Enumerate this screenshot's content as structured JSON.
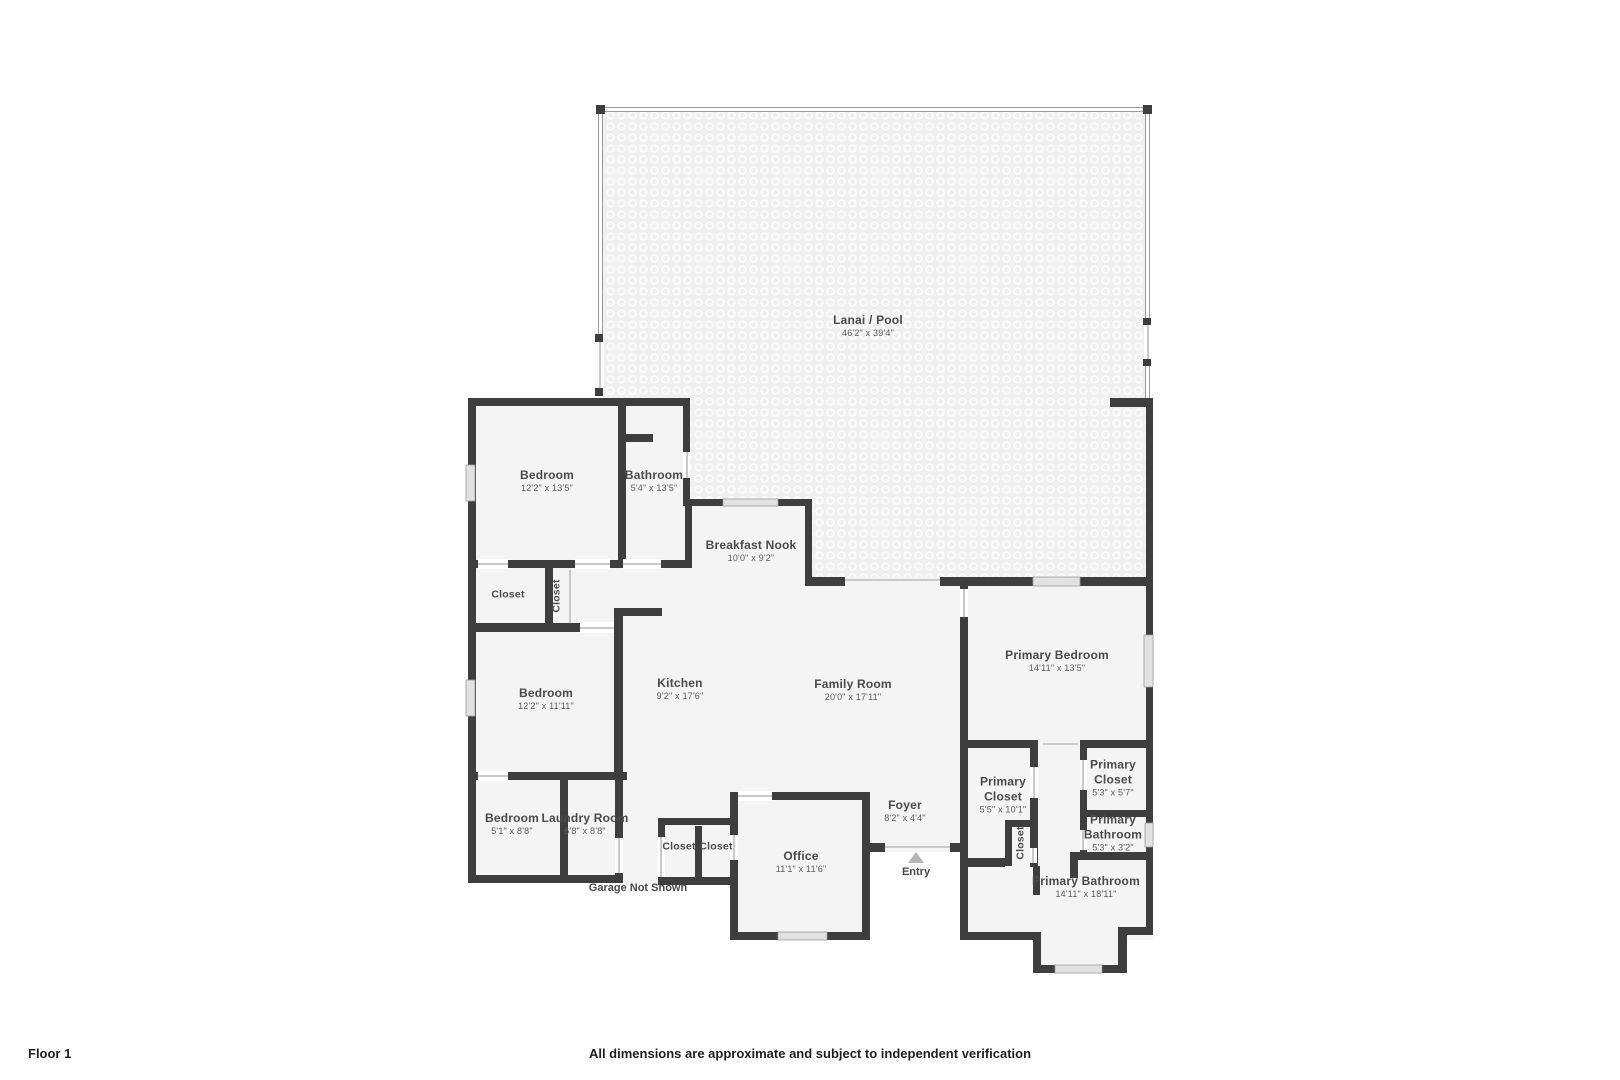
{
  "colors": {
    "wall": "#3e3e3e",
    "room_fill": "#f4f4f4",
    "lanai_fill": "#f0f0f0",
    "thin_wall": "#9b9b9b",
    "window": "#e2e2e2",
    "door": "#c9c9c9",
    "label_text": "#4a4a4a",
    "dims_text": "#5a5a5a",
    "footer_text": "#1f1f1f",
    "entry_arrow": "#b5b5b5"
  },
  "rooms": [
    {
      "id": "lanai",
      "name": "Lanai / Pool",
      "dims": "46'2\" x 39'4\""
    },
    {
      "id": "bedroom-top",
      "name": "Bedroom",
      "dims": "12'2\" x 13'5\""
    },
    {
      "id": "bathroom",
      "name": "Bathroom",
      "dims": "5'4\" x 13'5\""
    },
    {
      "id": "breakfast-nook",
      "name": "Breakfast Nook",
      "dims": "10'0\" x 9'2\""
    },
    {
      "id": "closet-hall-a",
      "name": "Closet"
    },
    {
      "id": "closet-hall-b",
      "name": "Closet"
    },
    {
      "id": "bedroom-middle",
      "name": "Bedroom",
      "dims": "12'2\" x 11'11\""
    },
    {
      "id": "kitchen",
      "name": "Kitchen",
      "dims": "9'2\" x 17'6\""
    },
    {
      "id": "family-room",
      "name": "Family Room",
      "dims": "20'0\" x 17'11\""
    },
    {
      "id": "primary-bedroom",
      "name": "Primary Bedroom",
      "dims": "14'11\" x 13'5\""
    },
    {
      "id": "primary-closet-left",
      "name": "Primary Closet",
      "dims": "5'5\" x 10'1\""
    },
    {
      "id": "primary-closet-right",
      "name": "Primary Closet",
      "dims": "5'3\" x 5'7\""
    },
    {
      "id": "primary-bathroom-small",
      "name": "Primary Bathroom",
      "dims": "5'3\" x 3'2\""
    },
    {
      "id": "closet-primary-small",
      "name": "Closet"
    },
    {
      "id": "primary-bathroom-large",
      "name": "Primary Bathroom",
      "dims": "14'11\" x 18'11\""
    },
    {
      "id": "bedroom-bottom",
      "name": "Bedroom",
      "dims": "5'1\" x 8'8\""
    },
    {
      "id": "laundry-room",
      "name": "Laundry Room",
      "dims": "6'8\" x 8'8\""
    },
    {
      "id": "closet-office-a",
      "name": "Closet"
    },
    {
      "id": "closet-office-b",
      "name": "Closet"
    },
    {
      "id": "office",
      "name": "Office",
      "dims": "11'1\" x 11'6\""
    },
    {
      "id": "foyer",
      "name": "Foyer",
      "dims": "8'2\" x 4'4\""
    }
  ],
  "annotations": {
    "entry": "Entry",
    "garage_note": "Garage Not Shown"
  },
  "footer": {
    "floor_label": "Floor 1",
    "disclaimer": "All dimensions are approximate and subject to independent verification"
  }
}
